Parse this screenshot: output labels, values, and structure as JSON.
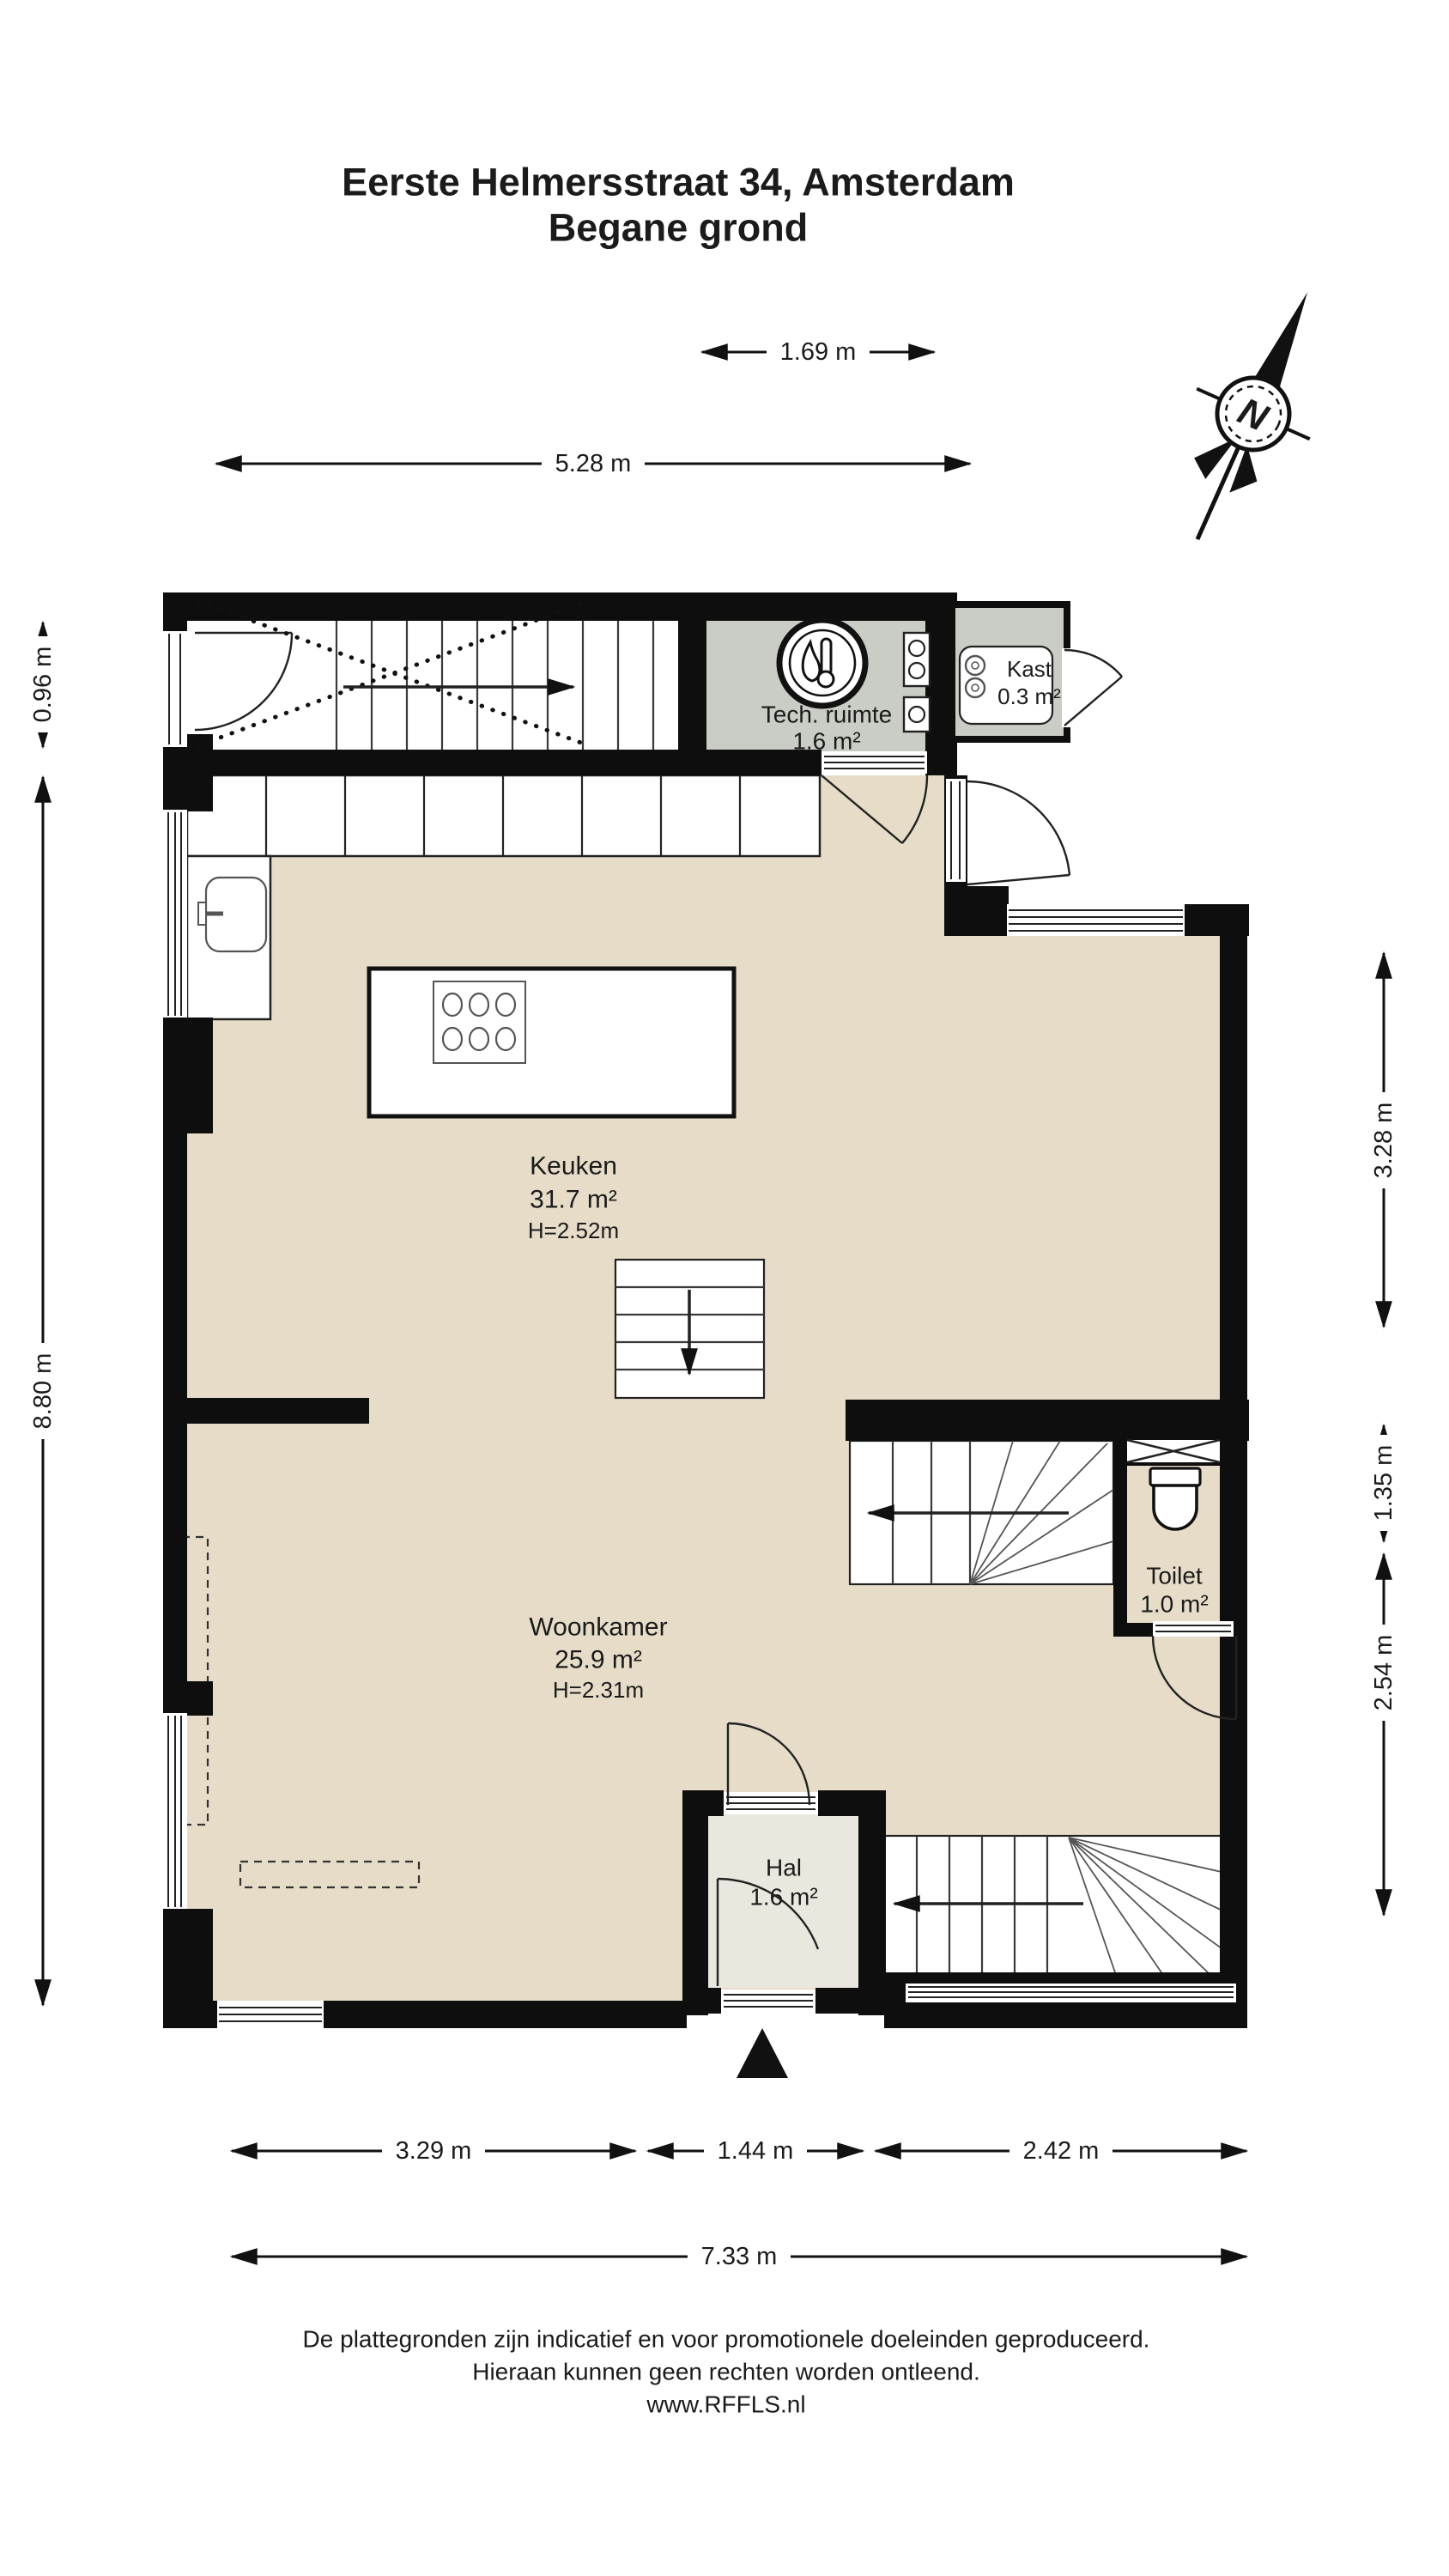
{
  "title": {
    "line1": "Eerste Helmersstraat 34, Amsterdam",
    "line2": "Begane grond"
  },
  "compass": {
    "label": "N"
  },
  "rooms": {
    "tech": {
      "name": "Tech. ruimte",
      "area": "1.6 m²"
    },
    "kast": {
      "name": "Kast",
      "area": "0.3 m²"
    },
    "keuken": {
      "name": "Keuken",
      "area": "31.7 m²",
      "ceiling": "H=2.52m"
    },
    "woonkamer": {
      "name": "Woonkamer",
      "area": "25.9 m²",
      "ceiling": "H=2.31m"
    },
    "toilet": {
      "name": "Toilet",
      "area": "1.0 m²"
    },
    "hal": {
      "name": "Hal",
      "area": "1.6 m²"
    }
  },
  "dimensions": {
    "top_inner": "1.69 m",
    "top_outer": "5.28 m",
    "left_top": "0.96 m",
    "left_main": "8.80 m",
    "right_top": "3.28 m",
    "right_middle": "1.35 m",
    "right_bottom": "2.54 m",
    "bottom_left": "3.29 m",
    "bottom_middle": "1.44 m",
    "bottom_right": "2.42 m",
    "bottom_total": "7.33 m"
  },
  "footer": {
    "line1": "De plattegronden zijn indicatief en voor promotionele doeleinden geproduceerd.",
    "line2": "Hieraan kunnen geen rechten worden ontleend.",
    "line3": "www.RFFLS.nl"
  },
  "colors": {
    "floor_main": "#e6dcc8",
    "floor_service": "#c9cdc5",
    "floor_hall": "#eae7df",
    "wall": "#0e0e0e"
  }
}
